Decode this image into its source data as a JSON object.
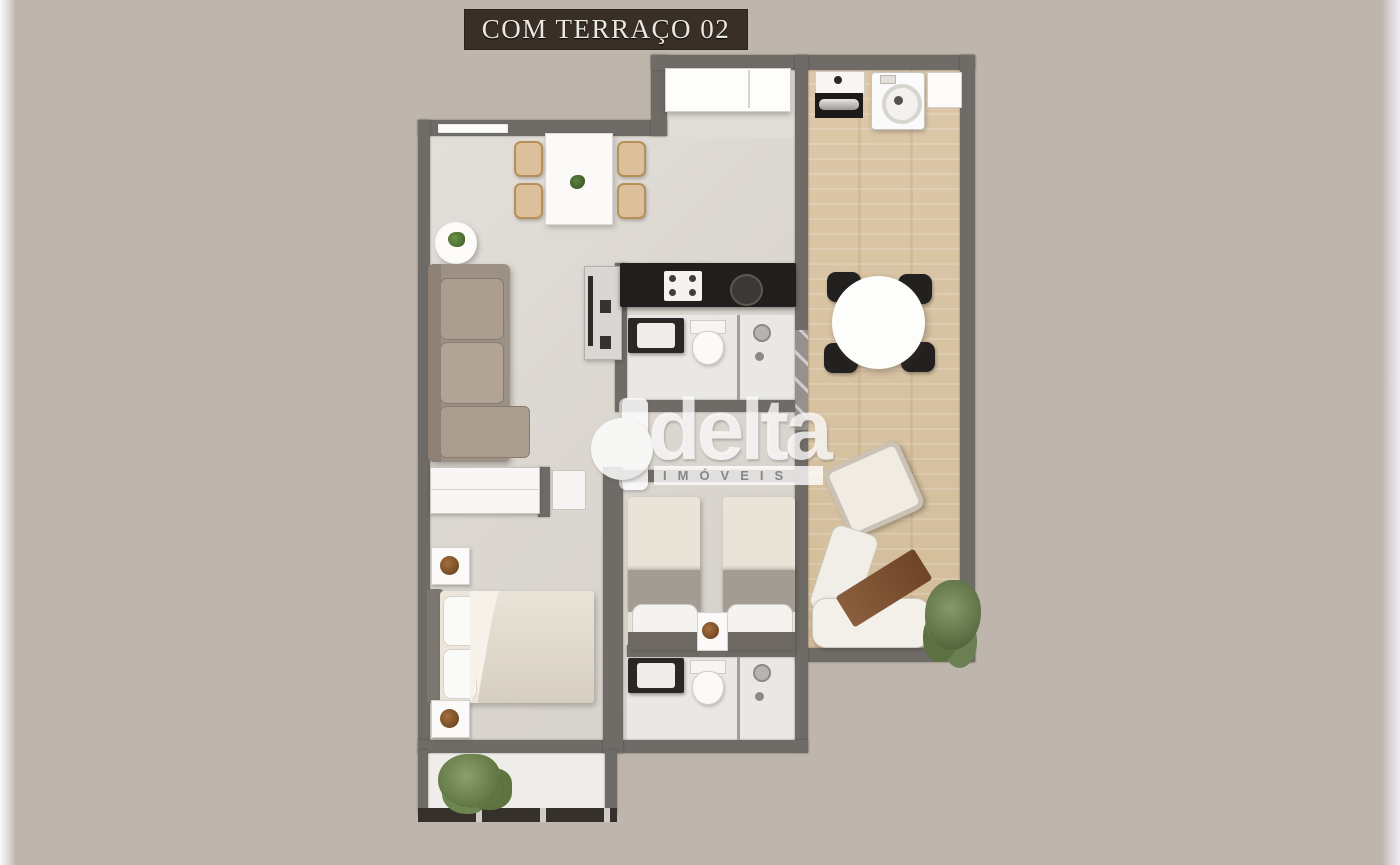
{
  "banner": {
    "label": "COM TERRAÇO 02"
  },
  "watermark": {
    "brand": "delta",
    "sub": "IMÓVEIS"
  },
  "palette": {
    "background": "#beb6ac",
    "wall": "#6f6b67",
    "apartment_floor": "#dedad5",
    "terrace_wood_floor": "#d6c2a2",
    "banner_background": "#3a2f27",
    "banner_text": "#eae6e0",
    "kitchen_counter": "#211e1d",
    "sofa": "#9d9084",
    "lounger_wood": "#8a5e3d",
    "plant_green": "#4c6332",
    "watermark_white": "#ffffff"
  }
}
